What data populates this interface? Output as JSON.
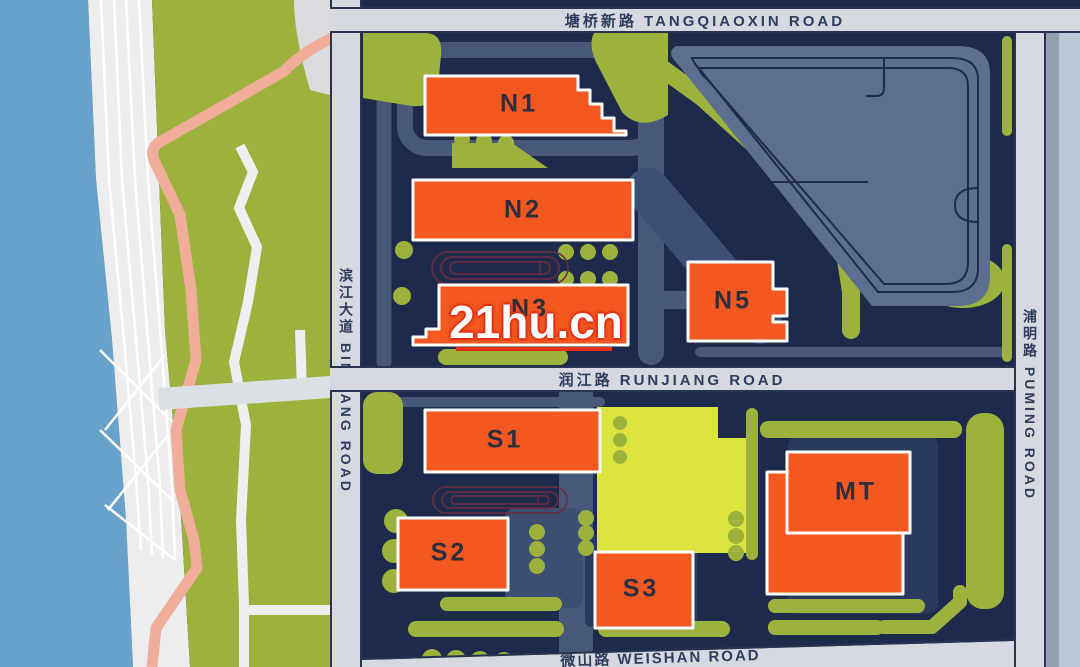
{
  "map": {
    "title": "residential site plan",
    "watermark": "21hu.cn",
    "roads": {
      "top": "塘桥新路 TANGQIAOXIN ROAD",
      "middle": "润江路 RUNJIANG ROAD",
      "bottom": "微山路 WEISHAN ROAD",
      "left": "滨江大道 BINJIANG ROAD",
      "right": "浦明路 PUMING ROAD"
    },
    "buildings": {
      "n1": "N1",
      "n2": "N2",
      "n3": "N3",
      "n5": "N5",
      "s1": "S1",
      "s2": "S2",
      "s3": "S3",
      "mt": "MT"
    },
    "features": {
      "river": "river",
      "promenade": "striped riverside promenade",
      "park": "riverside green park with pink and white footpaths",
      "parking": "parking lot with lane loops",
      "tracks": "two oval running tracks",
      "yellow_building": "yellow community building"
    },
    "colors": {
      "building_orange": "#f2581f",
      "landscape_green": "#9cb23c",
      "map_navy": "#1d2a4c",
      "road_gray": "#d6dae0",
      "river_blue": "#68a2ca",
      "yellow_building": "#dce23e",
      "path_pink": "#f0ad9a",
      "watermark_red": "#e53015"
    }
  }
}
